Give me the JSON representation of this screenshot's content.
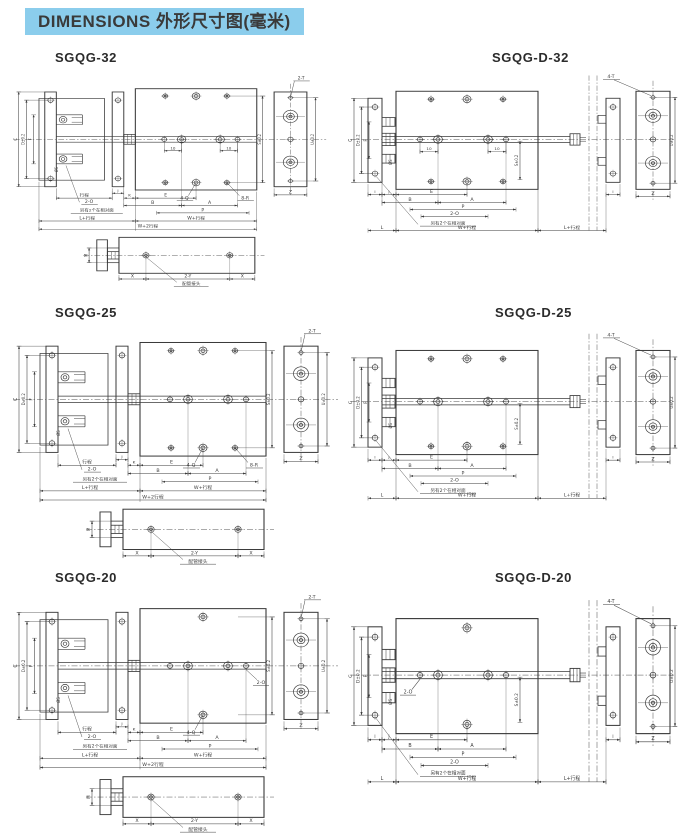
{
  "header": {
    "label": "DIMENSIONS 外形尺寸图(毫米)",
    "bg_color": "#8bcdec",
    "text_color": "#3a3a3a"
  },
  "line_color": "#3a3a3a",
  "labels": {
    "stroke": "行程",
    "two_o": "2-O",
    "opposite_note": "另有2个在相对面",
    "l_plus_stroke": "L+行程",
    "w_plus_stroke": "W+行程",
    "w_plus_2stroke": "W+2行程",
    "e": "E",
    "b": "B",
    "a": "A",
    "p": "P",
    "k": "K",
    "j": "J",
    "i": "I",
    "l": "L",
    "c": "C",
    "d_tol": "D±0.2",
    "f": "F",
    "s_tol": "S±0.2",
    "u_tol": "U±0.2",
    "z": "Z",
    "four_q": "4-Q",
    "eight_r": "8-R",
    "two_t": "2-T",
    "four_t": "4-T",
    "ten": "10",
    "m": "M",
    "x": "X",
    "two_y": "2-Y",
    "pipe_joint": "配管接头",
    "phi_s": "ØS"
  },
  "drawings": [
    {
      "id": "sgqg-32",
      "title": "SGQG-32",
      "type": "single",
      "top_holes": 3,
      "ten_dims": true,
      "eight_r": true,
      "rod_two_o": false,
      "end_callout": "2-T"
    },
    {
      "id": "sgqg-d-32",
      "title": "SGQG-D-32",
      "type": "double",
      "top_holes": 3,
      "ten_dims": true,
      "eight_r": true,
      "rod_two_o": false,
      "end_callout": "4-T"
    },
    {
      "id": "sgqg-25",
      "title": "SGQG-25",
      "type": "single",
      "top_holes": 3,
      "ten_dims": false,
      "eight_r": true,
      "rod_two_o": false,
      "end_callout": "2-T"
    },
    {
      "id": "sgqg-d-25",
      "title": "SGQG-D-25",
      "type": "double",
      "top_holes": 3,
      "ten_dims": false,
      "eight_r": true,
      "rod_two_o": false,
      "end_callout": "4-T"
    },
    {
      "id": "sgqg-20",
      "title": "SGQG-20",
      "type": "single",
      "top_holes": 1,
      "ten_dims": false,
      "eight_r": false,
      "rod_two_o": true,
      "end_callout": "2-T"
    },
    {
      "id": "sgqg-d-20",
      "title": "SGQG-D-20",
      "type": "double",
      "top_holes": 1,
      "ten_dims": false,
      "eight_r": false,
      "rod_two_o": true,
      "end_callout": "4-T"
    }
  ]
}
